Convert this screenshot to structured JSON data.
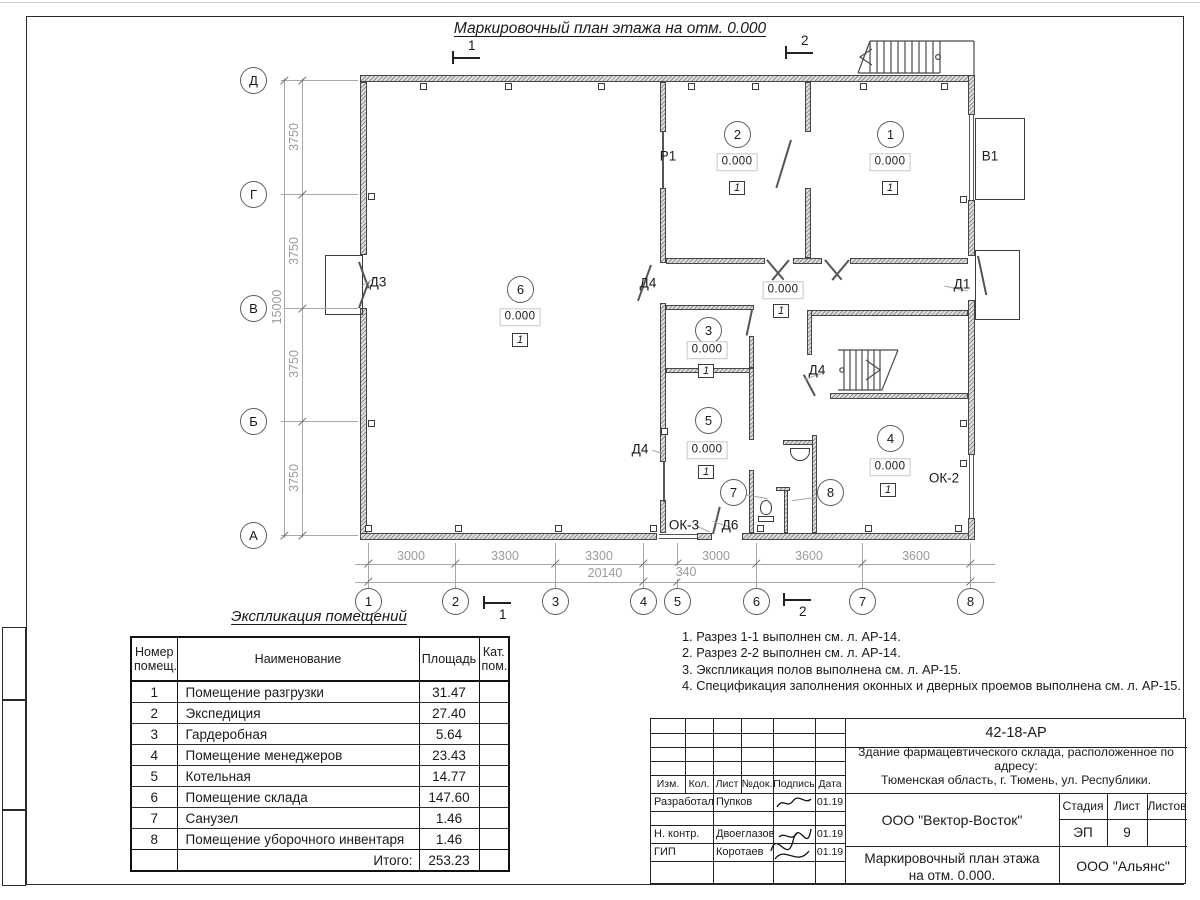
{
  "sheet": {
    "plan_title": "Маркировочный план этажа на отм. 0.000",
    "legend_title": "Экспликация помещений"
  },
  "plan": {
    "room_markers": [
      {
        "n": "1",
        "x": 890,
        "y": 134
      },
      {
        "n": "2",
        "x": 737,
        "y": 134
      },
      {
        "n": "3",
        "x": 708,
        "y": 330
      },
      {
        "n": "4",
        "x": 890,
        "y": 438
      },
      {
        "n": "5",
        "x": 708,
        "y": 420
      },
      {
        "n": "6",
        "x": 520,
        "y": 289
      },
      {
        "n": "7",
        "x": 733,
        "y": 492
      },
      {
        "n": "8",
        "x": 830,
        "y": 492
      }
    ],
    "elevation_marks": [
      {
        "t": "0.000",
        "x": 737,
        "y": 162
      },
      {
        "t": "0.000",
        "x": 890,
        "y": 162
      },
      {
        "t": "0.000",
        "x": 783,
        "y": 290
      },
      {
        "t": "0.000",
        "x": 707,
        "y": 350
      },
      {
        "t": "0.000",
        "x": 707,
        "y": 450
      },
      {
        "t": "0.000",
        "x": 520,
        "y": 317
      },
      {
        "t": "0.000",
        "x": 890,
        "y": 467
      }
    ],
    "floor_type_marks": [
      {
        "t": "1",
        "x": 737,
        "y": 188
      },
      {
        "t": "1",
        "x": 890,
        "y": 188
      },
      {
        "t": "1",
        "x": 781,
        "y": 311
      },
      {
        "t": "1",
        "x": 706,
        "y": 371
      },
      {
        "t": "1",
        "x": 706,
        "y": 472
      },
      {
        "t": "1",
        "x": 520,
        "y": 340
      },
      {
        "t": "1",
        "x": 888,
        "y": 490
      }
    ],
    "opening_labels": [
      {
        "t": "Д3",
        "x": 378,
        "y": 282
      },
      {
        "t": "Д4",
        "x": 648,
        "y": 283
      },
      {
        "t": "Д4",
        "x": 640,
        "y": 449
      },
      {
        "t": "Д4",
        "x": 817,
        "y": 370
      },
      {
        "t": "Д6",
        "x": 730,
        "y": 525
      },
      {
        "t": "Д1",
        "x": 962,
        "y": 284
      },
      {
        "t": "Р1",
        "x": 668,
        "y": 156
      },
      {
        "t": "В1",
        "x": 990,
        "y": 156
      },
      {
        "t": "ОК-2",
        "x": 944,
        "y": 478
      },
      {
        "t": "ОК-3",
        "x": 684,
        "y": 525
      }
    ],
    "axes_bottom": [
      {
        "n": "1",
        "x": 368
      },
      {
        "n": "2",
        "x": 455
      },
      {
        "n": "3",
        "x": 555
      },
      {
        "n": "4",
        "x": 643
      },
      {
        "n": "5",
        "x": 677
      },
      {
        "n": "6",
        "x": 756
      },
      {
        "n": "7",
        "x": 862
      },
      {
        "n": "8",
        "x": 970
      }
    ],
    "axes_left": [
      {
        "n": "Д",
        "y": 80
      },
      {
        "n": "Г",
        "y": 194
      },
      {
        "n": "В",
        "y": 308
      },
      {
        "n": "Б",
        "y": 421
      },
      {
        "n": "А",
        "y": 535
      }
    ],
    "dims_bottom_row1": [
      {
        "t": "3000",
        "x": 411
      },
      {
        "t": "3300",
        "x": 505
      },
      {
        "t": "3300",
        "x": 599
      },
      {
        "t": "3000",
        "x": 716
      },
      {
        "t": "3600",
        "x": 809
      },
      {
        "t": "3600",
        "x": 916
      }
    ],
    "dims_bottom_row2": [
      {
        "t": "20140",
        "x": 605,
        "y": 573
      },
      {
        "t": "340",
        "x": 686,
        "y": 572
      }
    ],
    "dims_left": [
      {
        "t": "3750",
        "x": 294,
        "y": 137
      },
      {
        "t": "3750",
        "x": 294,
        "y": 251
      },
      {
        "t": "3750",
        "x": 294,
        "y": 364
      },
      {
        "t": "3750",
        "x": 294,
        "y": 478
      },
      {
        "t": "15000",
        "x": 277,
        "y": 307
      }
    ],
    "section_markers": [
      {
        "n": "1",
        "x": 452,
        "y": 57,
        "pos": "above"
      },
      {
        "n": "2",
        "x": 785,
        "y": 52,
        "pos": "above"
      },
      {
        "n": "1",
        "x": 483,
        "y": 602,
        "pos": "below"
      },
      {
        "n": "2",
        "x": 783,
        "y": 599,
        "pos": "below"
      }
    ]
  },
  "legend_table": {
    "headers": {
      "num": "Номер\nпомещ.",
      "name": "Наименование",
      "area": "Площадь",
      "cat": "Кат.\nпом."
    },
    "rows": [
      [
        "1",
        "Помещение разгрузки",
        "31.47"
      ],
      [
        "2",
        "Экспедиция",
        "27.40"
      ],
      [
        "3",
        "Гардеробная",
        "5.64"
      ],
      [
        "4",
        "Помещение менеджеров",
        "23.43"
      ],
      [
        "5",
        "Котельная",
        "14.77"
      ],
      [
        "6",
        "Помещение склада",
        "147.60"
      ],
      [
        "7",
        "Санузел",
        "1.46"
      ],
      [
        "8",
        "Помещение уборочного инвентаря",
        "1.46"
      ]
    ],
    "total_label": "Итого:",
    "total_value": "253.23"
  },
  "notes": {
    "items": [
      "1. Разрез 1-1 выполнен см. л. АР-14.",
      "2. Разрез 2-2 выполнен см. л. АР-14.",
      "3. Экспликация полов выполнена см. л. АР-15.",
      "4. Спецификация заполнения оконных и дверных проемов выполнена см. л. АР-15."
    ]
  },
  "title_block": {
    "doc_number": "42-18-АР",
    "object_line1": "Здание фармацевтического склада, расположенное по адресу:",
    "object_line2": "Тюменская область, г. Тюмень, ул. Республики.",
    "columns": {
      "izm": "Изм.",
      "kol": "Кол.",
      "list": "Лист",
      "ndok": "№док.",
      "podpis": "Подпись",
      "data": "Дата"
    },
    "sign_rows": [
      {
        "role": "Разработал",
        "name": "Пупков",
        "date": "01.19"
      },
      {
        "role": "Н. контр.",
        "name": "Двоеглазов",
        "date": "01.19"
      },
      {
        "role": "ГИП",
        "name": "Коротаев",
        "date": "01.19"
      }
    ],
    "org_designer": "ООО \"Вектор-Восток\"",
    "stage_label": "Стадия",
    "sheet_label": "Лист",
    "sheets_label": "Листов",
    "stage_value": "ЭП",
    "sheet_value": "9",
    "sheets_value": "",
    "drawing_name_line1": "Маркировочный план этажа",
    "drawing_name_line2": "на отм. 0.000.",
    "org_customer": "ООО \"Альянс\""
  }
}
